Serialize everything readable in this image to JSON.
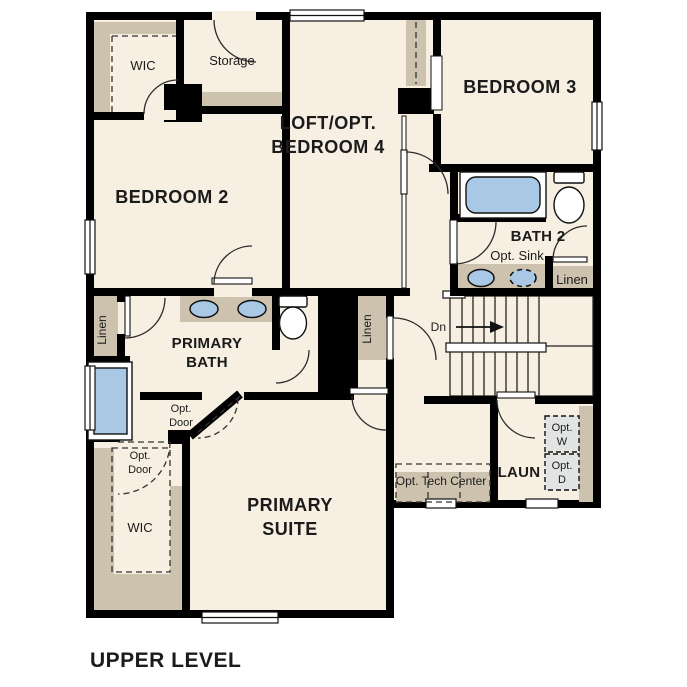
{
  "title": "UPPER LEVEL",
  "labels": {
    "wic_top": "WIC",
    "storage": "Storage",
    "loft_line1": "LOFT/OPT.",
    "loft_line2": "BEDROOM 4",
    "bedroom3": "BEDROOM 3",
    "bedroom2": "BEDROOM 2",
    "bath2": "BATH 2",
    "opt_sink": "Opt. Sink",
    "linen_bath2": "Linen",
    "stairs_dn": "Dn",
    "linen_left": "Linen",
    "primary_bath_line1": "PRIMARY",
    "primary_bath_line2": "BATH",
    "linen_mid": "Linen",
    "opt_door_1_line1": "Opt.",
    "opt_door_1_line2": "Door",
    "opt_door_2_line1": "Opt.",
    "opt_door_2_line2": "Door",
    "primary_suite_line1": "PRIMARY",
    "primary_suite_line2": "SUITE",
    "wic_primary": "WIC",
    "opt_tech_center": "Opt. Tech Center",
    "laundry": "LAUN",
    "opt_washer_line1": "Opt.",
    "opt_washer_line2": "W",
    "opt_dryer_line1": "Opt.",
    "opt_dryer_line2": "D"
  },
  "colors": {
    "wall": "#000000",
    "room_fill": "#f6efe2",
    "closet_tan": "#cdc2ae",
    "fixture_blue": "#a9c8e6",
    "appliance_gray": "#e2e4e4",
    "text": "#1b1b1b"
  }
}
